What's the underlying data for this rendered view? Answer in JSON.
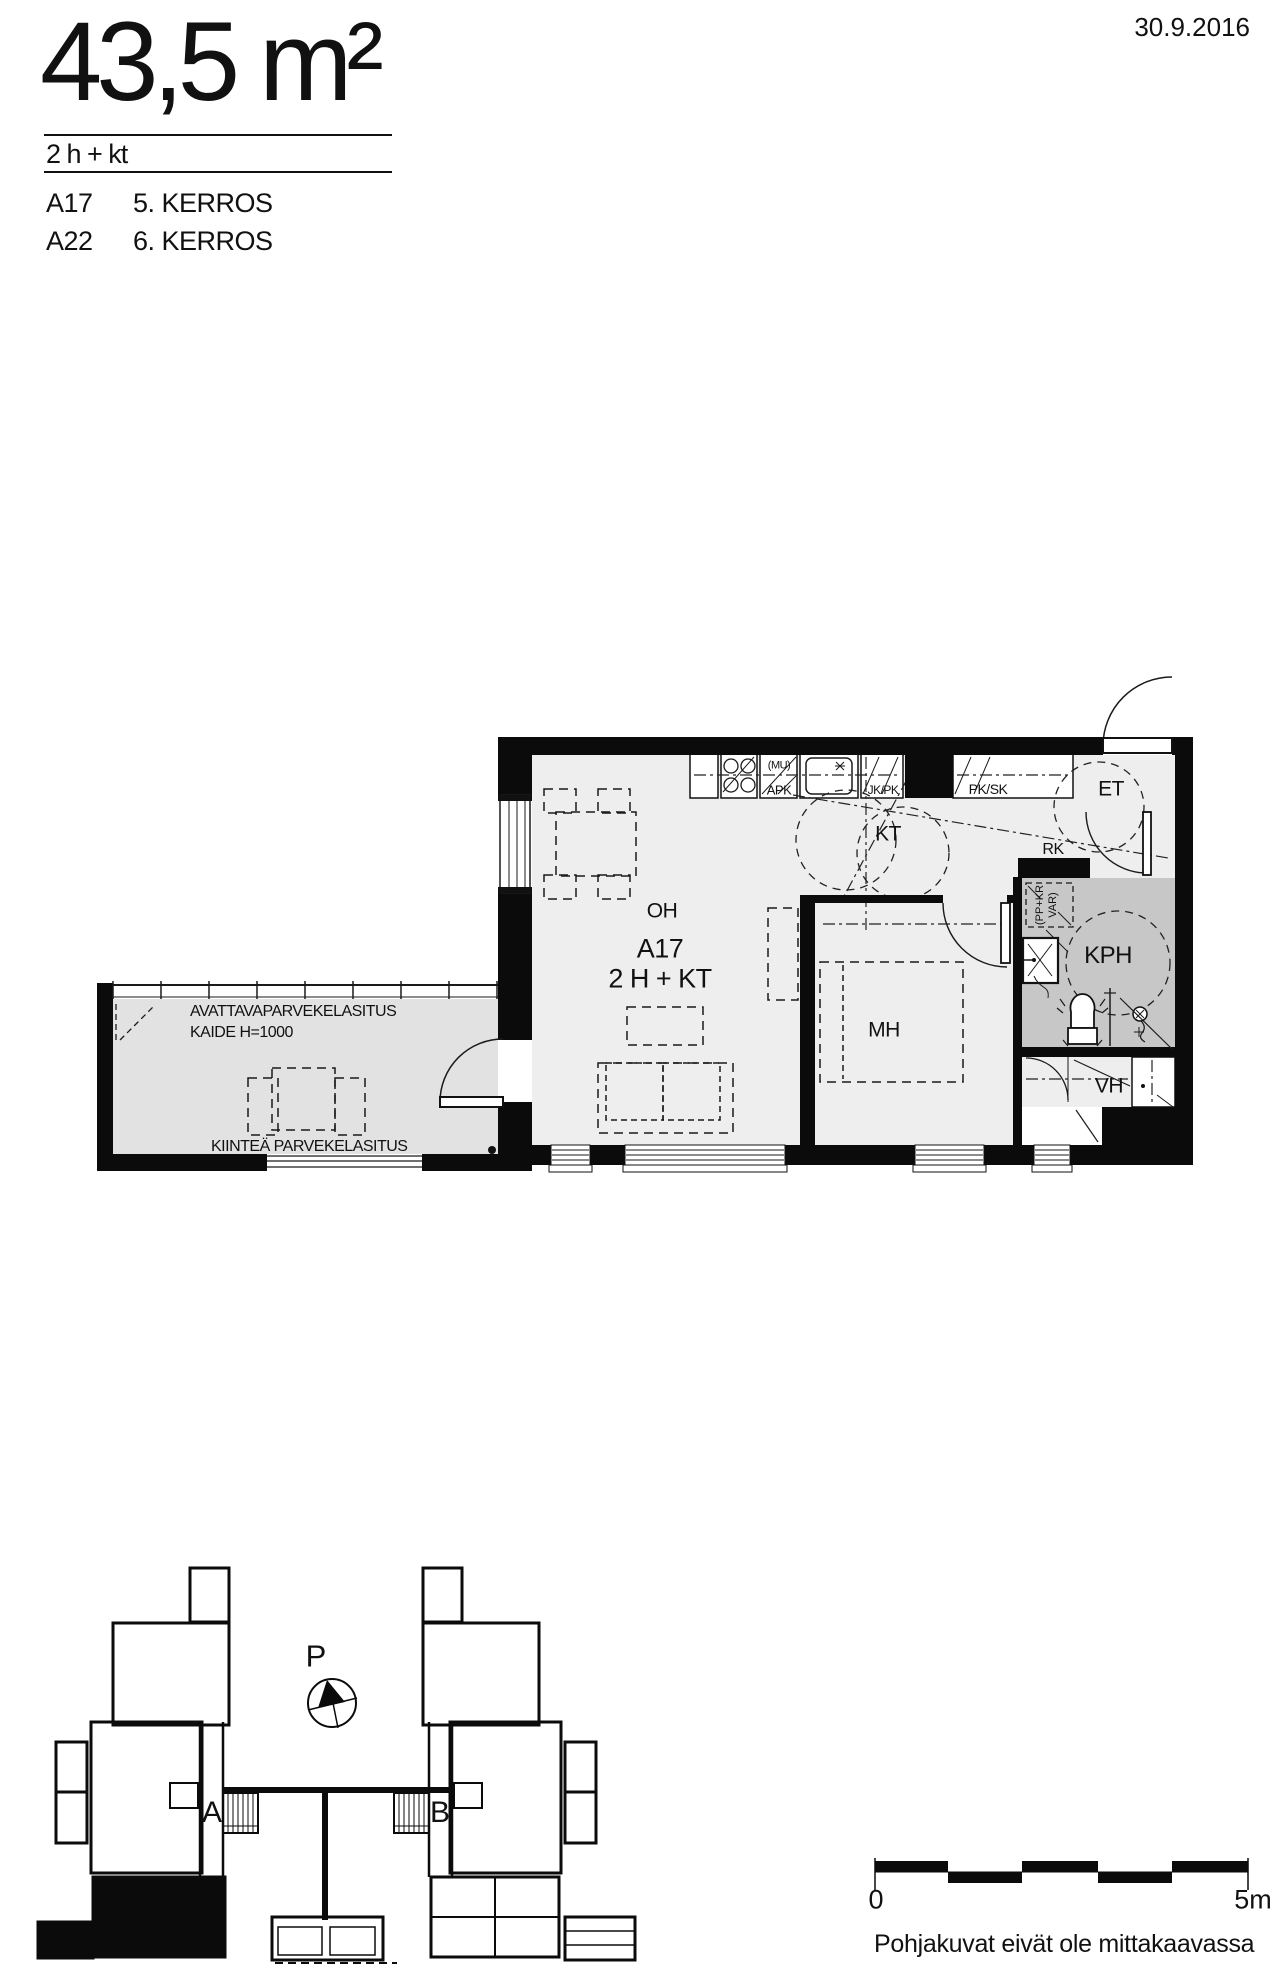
{
  "header": {
    "area": "43,5 m²",
    "layout": "2 h + kt",
    "units": [
      {
        "unit": "A17",
        "floor": "5. KERROS"
      },
      {
        "unit": "A22",
        "floor": "6. KERROS"
      }
    ],
    "date": "30.9.2016"
  },
  "plan": {
    "unit_id": "A17",
    "unit_type": "2 H + KT",
    "rooms": {
      "oh": "OH",
      "kt": "KT",
      "mh": "MH",
      "kph": "KPH",
      "et": "ET",
      "vh": "VH",
      "rk": "RK"
    },
    "kitchen": {
      "mu": "(MU)",
      "apk": "APK",
      "jk_pk": "JK/PK",
      "pk_sk": "PK/SK"
    },
    "storage": {
      "line1": "(PP+KR",
      "line2": "VAR)"
    },
    "balcony": {
      "openable": "AVATTAVAPARVEKELASITUS",
      "railing": "KAIDE H=1000",
      "fixed": "KIINTEÄ PARVEKELASITUS"
    }
  },
  "site": {
    "north": "P",
    "stair_a": "A",
    "stair_b": "B"
  },
  "scale": {
    "zero": "0",
    "five": "5m",
    "note": "Pohjakuvat eivät ole mittakaavassa"
  },
  "colors": {
    "wall": "#0b0b0b",
    "floor": "#eeeeee",
    "balcony_floor": "#e2e2e2",
    "bathroom_floor": "#c7c7c7"
  }
}
